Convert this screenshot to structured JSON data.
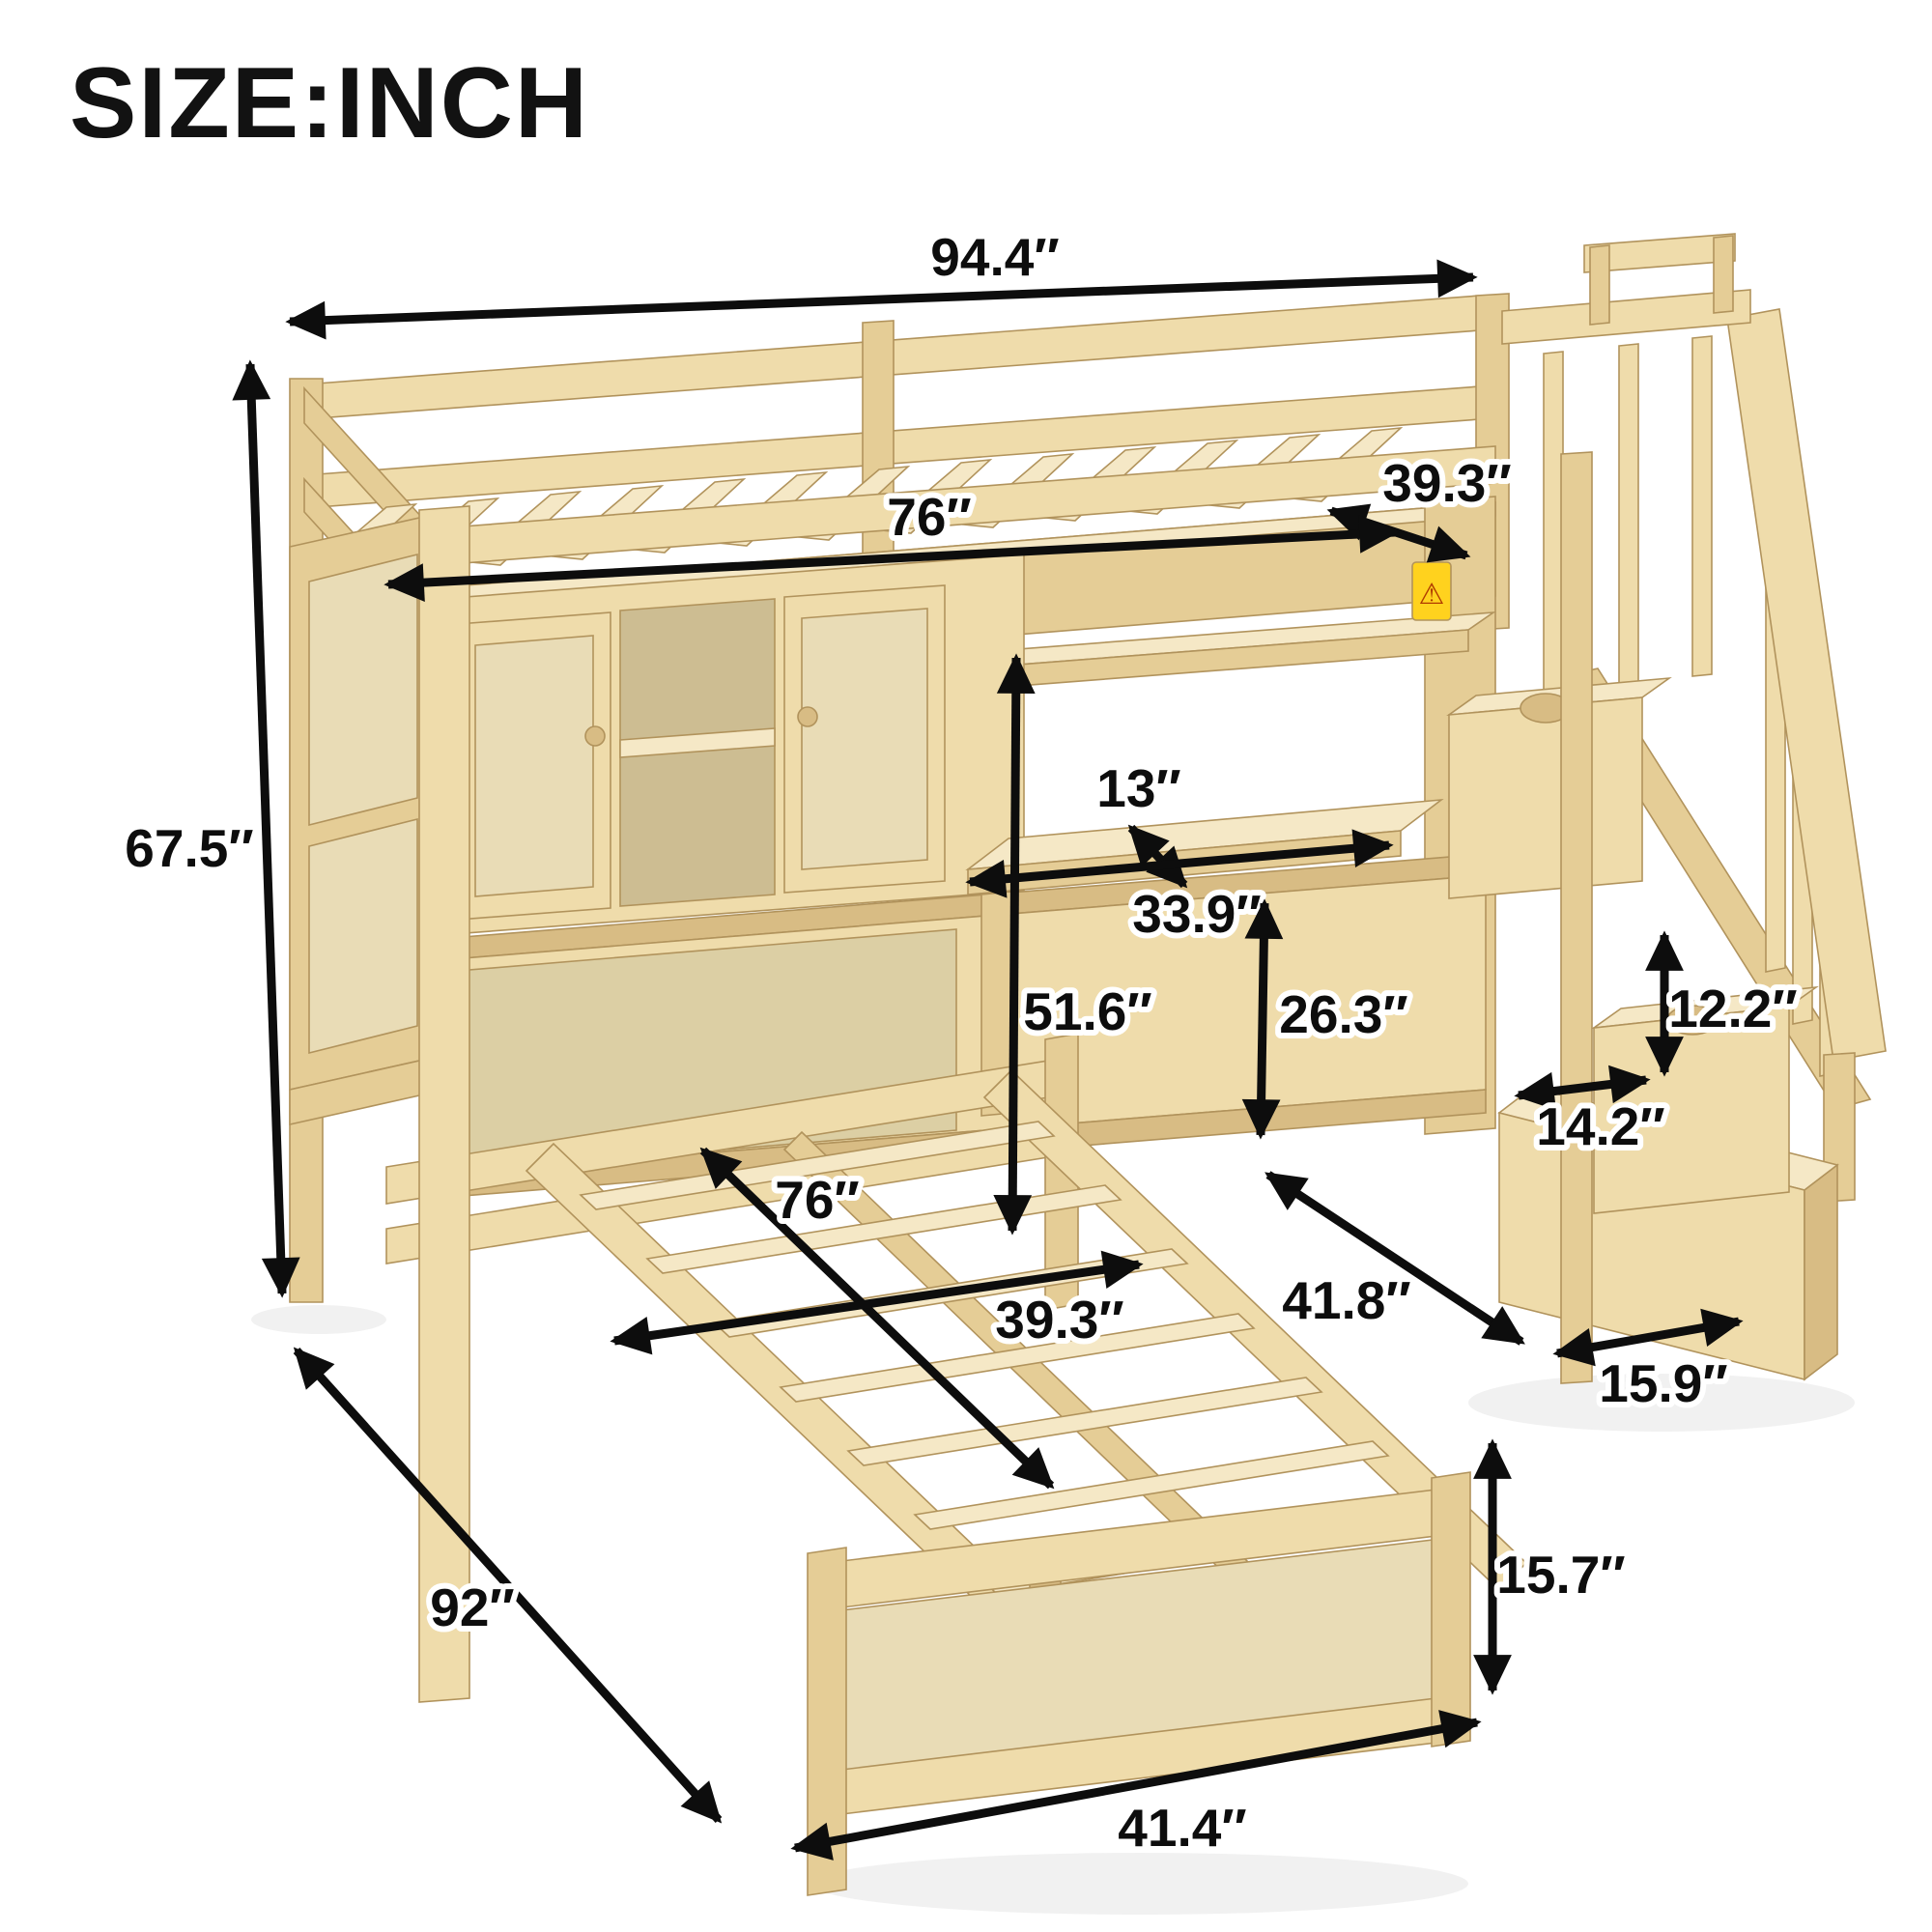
{
  "title": "SIZE:INCH",
  "warning_icon": "⚠",
  "dimensions": {
    "loft_length_overall": "94.4″",
    "loft_bed_width": "39.3″",
    "loft_bed_length": "76″",
    "overall_height": "67.5″",
    "shelf_depth": "13″",
    "desk_width": "33.9″",
    "under_loft_clearance": "51.6″",
    "desk_height": "26.3″",
    "stair_storage_height": "12.2″",
    "stair_step_depth": "14.2″",
    "stair_depth_overall": "41.8″",
    "stair_width": "15.9″",
    "platform_bed_length": "76″",
    "platform_bed_width": "39.3″",
    "overall_depth": "92″",
    "platform_bed_height": "15.7″",
    "platform_bed_frame_width": "41.4″"
  }
}
